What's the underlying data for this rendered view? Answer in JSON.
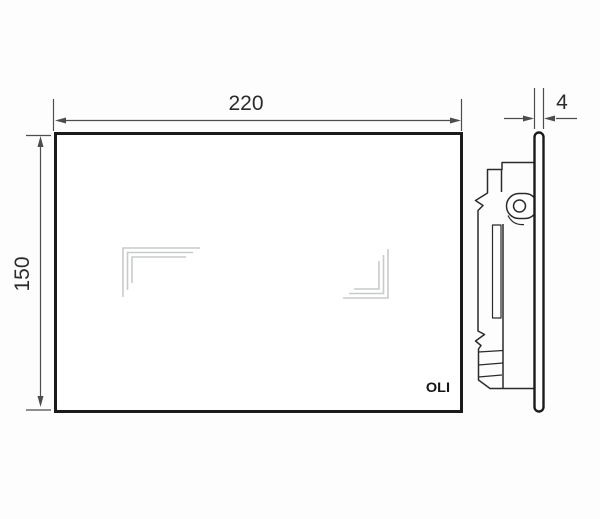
{
  "front_view": {
    "width_label": "220",
    "height_label": "150",
    "brand_logo": "OLI"
  },
  "side_view": {
    "thickness_label": "4"
  },
  "icons": {
    "touch_zone_left": "l-corner-mark",
    "touch_zone_right": "l-corner-mark-mirrored"
  },
  "colors": {
    "plate_outline": "#1b1b1b",
    "mechanism_line": "#2b2b2b",
    "dimension_line": "#4d4d4d",
    "touch_mark": "#c7cbca",
    "background": "#fdfdfd",
    "plate_fill": "#ffffff"
  }
}
